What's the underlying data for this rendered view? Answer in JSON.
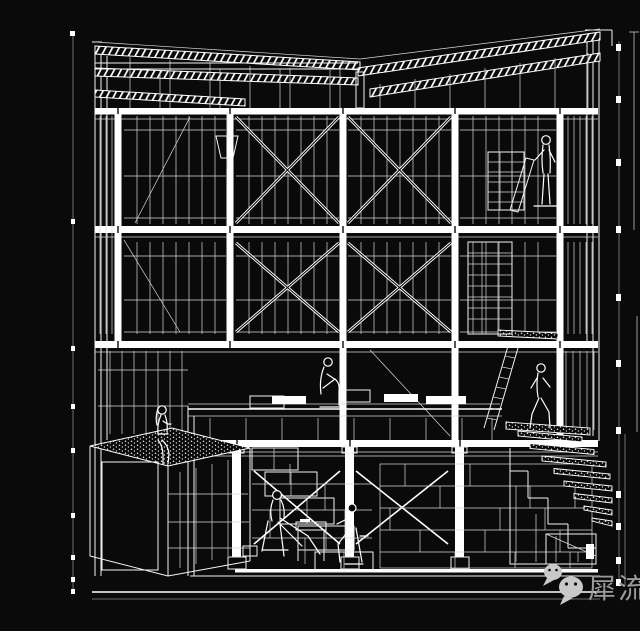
{
  "canvas": {
    "width": 640,
    "height": 599,
    "background": "#0a0a0a",
    "ink": "#f2f2f2"
  },
  "artwork": {
    "kind": "white line-art architectural cutaway section / axonometric on black",
    "figure_count": 6,
    "features": [
      "butterfly-roof-trusses",
      "three-storey-braced-timber-frame",
      "x-braced-window-bays",
      "planted-roof-box",
      "central-mezzanine-platform",
      "basement-meeting-scene",
      "right-side-masonry-staircase",
      "leaning-ladder",
      "wall-shelving"
    ]
  },
  "watermark": {
    "text": "犀流剪报",
    "text_color": "#9a9a9a",
    "icon": "wechat-logo",
    "icon_color": "#c9c9c9"
  }
}
